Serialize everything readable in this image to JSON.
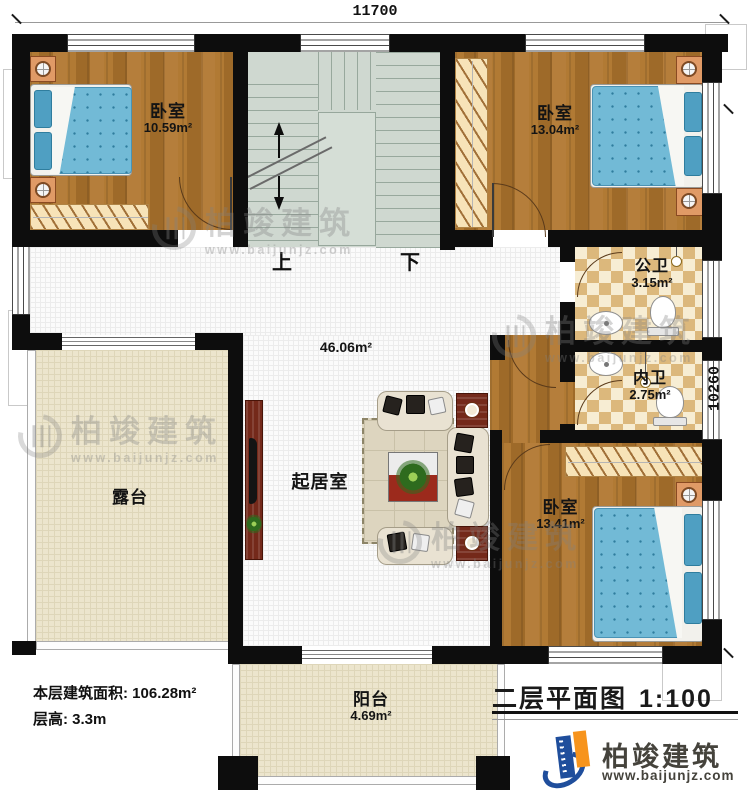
{
  "dimensions": {
    "width": "11700",
    "height": "10260"
  },
  "stairs": {
    "up_label": "上",
    "down_label": "下"
  },
  "rooms": {
    "bedroom_nw": {
      "name": "卧室",
      "area": "10.59m²"
    },
    "bedroom_ne": {
      "name": "卧室",
      "area": "13.04m²"
    },
    "public_bathroom": {
      "name": "公卫",
      "area": "3.15m²"
    },
    "private_bathroom": {
      "name": "内卫",
      "area": "2.75m²"
    },
    "living_room": {
      "name": "起居室",
      "area": "46.06m²"
    },
    "bedroom_se": {
      "name": "卧室",
      "area": "13.41m²"
    },
    "terrace": {
      "name": "露台"
    },
    "balcony": {
      "name": "阳台",
      "area": "4.69m²"
    }
  },
  "info": {
    "floor_area_label": "本层建筑面积:",
    "floor_area_value": "106.28m²",
    "floor_height_label": "层高:",
    "floor_height_value": "3.3m"
  },
  "title": {
    "name": "二层平面图",
    "scale": "1:100"
  },
  "brand": {
    "name": "柏竣建筑",
    "website": "www.baijunjz.com"
  },
  "watermark": {
    "name": "柏竣建筑",
    "website": "www.baijunjz.com"
  },
  "colors": {
    "wall": "#0d0d0d",
    "wood_floor": "#a9712f",
    "tile_dark": "#dcb87c",
    "tile_light": "#f7edd3",
    "stairs": "#cfd8d0",
    "terrace": "#ece5cd",
    "mattress_blue": "#72bad6",
    "brand_blue": "#1f4e9c",
    "brand_orange": "#f7941d"
  }
}
